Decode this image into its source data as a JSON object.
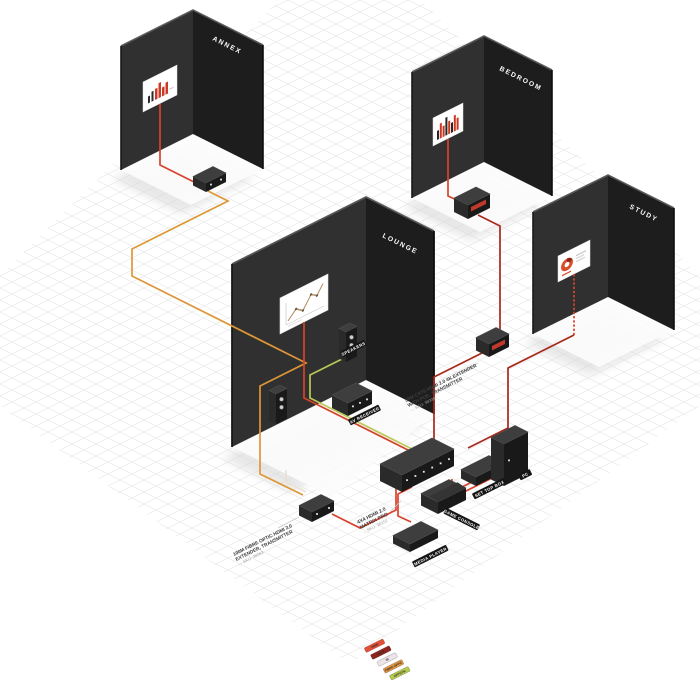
{
  "diagram": {
    "rooms": [
      {
        "name": "ANNEX"
      },
      {
        "name": "BEDROOM"
      },
      {
        "name": "LOUNGE"
      },
      {
        "name": "STUDY"
      }
    ],
    "device_tags": {
      "speakers": "SPEAKERS",
      "av_receiver": "AV RECEIVER",
      "media_player": "MEDIA PLAYER",
      "game_console": "GAME CONSOLE",
      "set_top_box": "SET TOP BOX",
      "pc": "PC"
    },
    "annotations": {
      "matrix": {
        "line1": "4X4 HDMI 2.0",
        "line2": "MATRIX PRO",
        "sku": "→ SKU: 38152"
      },
      "cat6_extender": {
        "line1": "50M CAT6 HDMI 2.0 4K EXTENDER",
        "line2": "WITH POE, TRANSMITTER",
        "sku": "→ SKU: 38339"
      },
      "fibre_extender": {
        "line1": "100M FIBRE OPTIC HDMI 2.0",
        "line2": "EXTENDER, TRANSMITTER",
        "sku": "→ SKU: 38063"
      }
    },
    "legend": [
      {
        "label": "HDMI",
        "color": "#e25038"
      },
      {
        "label": "CAT6",
        "color": "#8e241c"
      },
      {
        "label": "IR",
        "color": "#ece4ea"
      },
      {
        "label": "FIBRE OPTIC",
        "color": "#e39440"
      },
      {
        "label": "OPTICAL",
        "color": "#b5c94e"
      }
    ],
    "cable_colors": {
      "hdmi": "#d8422c",
      "cat6": "#a8281c",
      "fibre": "#de9736",
      "optical": "#b9cb55",
      "ir": "#e9e1d4",
      "pointer": "#c9c9c9"
    },
    "scene_colors": {
      "wall_left": "#303030",
      "wall_right": "#1d1d1d",
      "grid": "#e8e8e8",
      "background": "#ffffff"
    }
  }
}
